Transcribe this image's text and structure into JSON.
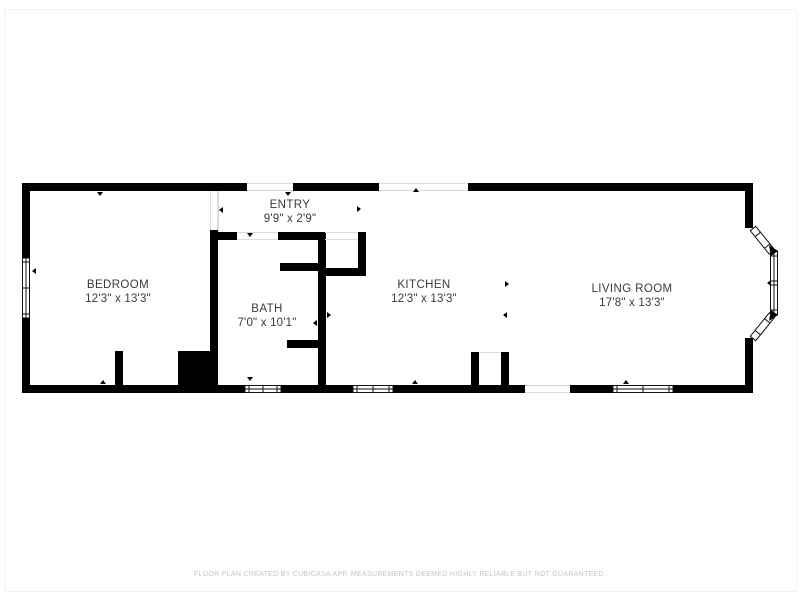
{
  "palette": {
    "background": "#ffffff",
    "wall": "#000000",
    "label_text": "#3a3a3a",
    "footer_text": "#c5c5c5",
    "opening_outline": "#dcdcdc"
  },
  "rooms": [
    {
      "id": "bedroom",
      "name": "BEDROOM",
      "dimensions": "12'3\" x 13'3\""
    },
    {
      "id": "entry",
      "name": "ENTRY",
      "dimensions": "9'9\" x 2'9\""
    },
    {
      "id": "bath",
      "name": "BATH",
      "dimensions": "7'0\" x 10'1\""
    },
    {
      "id": "kitchen",
      "name": "KITCHEN",
      "dimensions": "12'3\" x 13'3\""
    },
    {
      "id": "living_room",
      "name": "LIVING ROOM",
      "dimensions": "17'8\" x 13'3\""
    }
  ],
  "footer": {
    "disclaimer": "FLOOR PLAN CREATED BY CUBICASA APP. MEASUREMENTS DEEMED HIGHLY RELIABLE BUT NOT GUARANTEED."
  }
}
